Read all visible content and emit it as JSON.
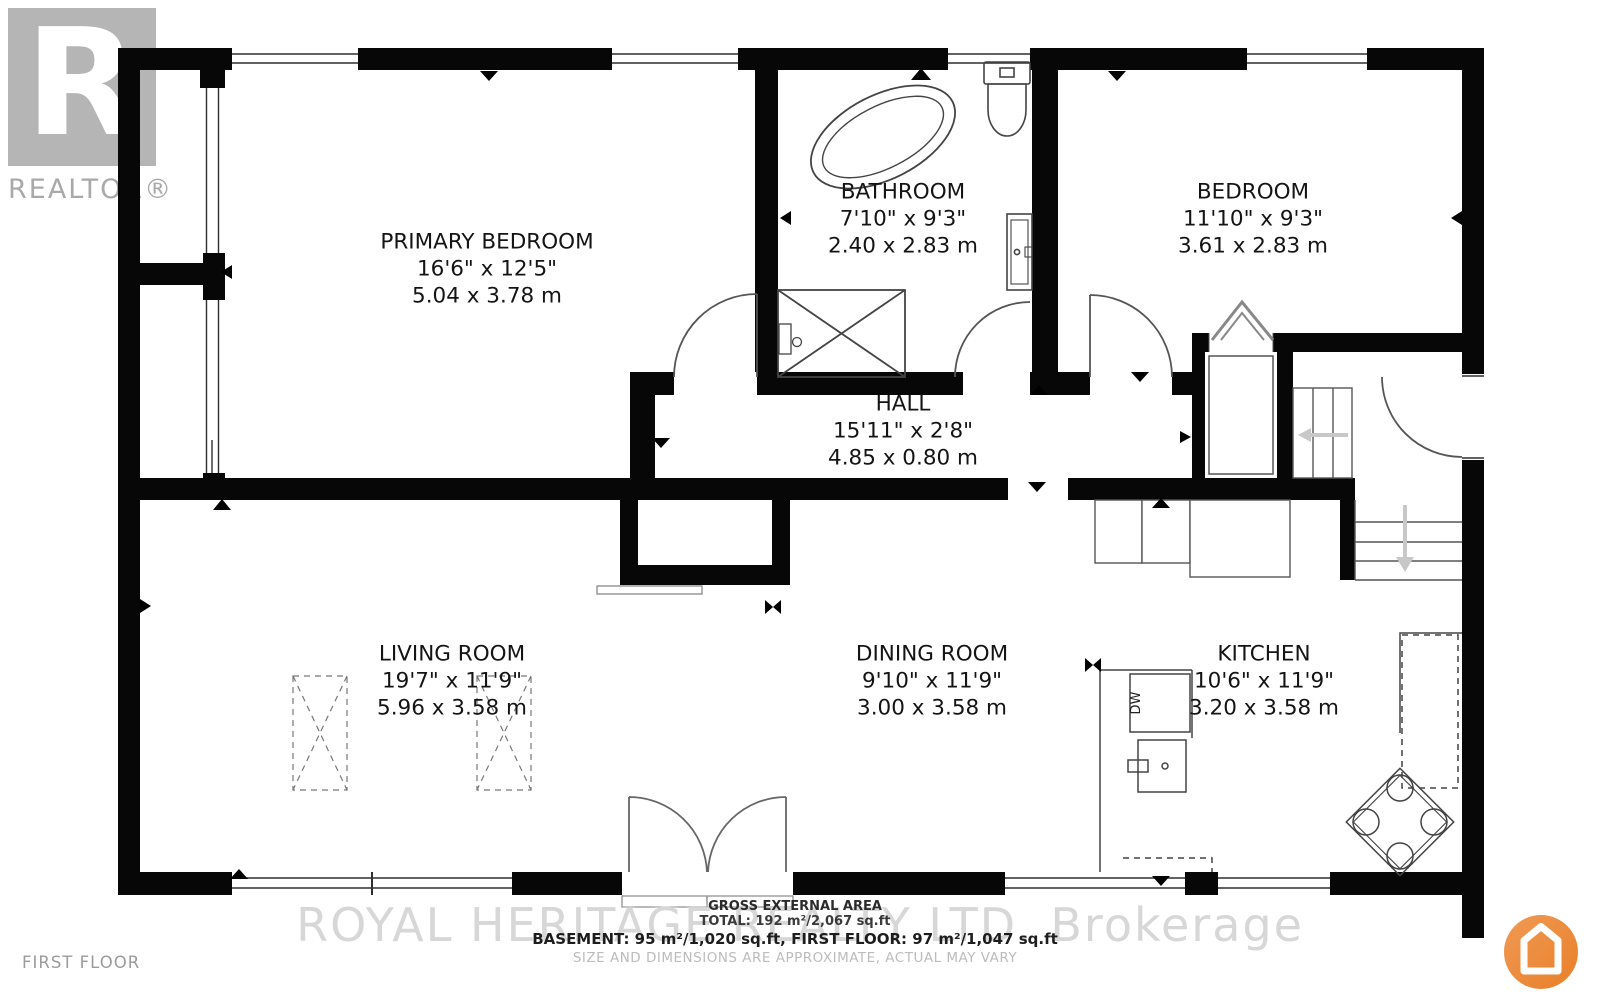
{
  "branding": {
    "realtor_logo_letter": "R",
    "realtor_logo_text": "REALTOR®",
    "floor_label": "FIRST FLOOR",
    "watermark": "ROYAL HERITAGE REALTY LTD.  Brokerage"
  },
  "rooms": [
    {
      "name": "PRIMARY BEDROOM",
      "imperial": "16'6\" x 12'5\"",
      "metric": "5.04 x 3.78 m"
    },
    {
      "name": "BATHROOM",
      "imperial": "7'10\" x 9'3\"",
      "metric": "2.40 x 2.83 m"
    },
    {
      "name": "BEDROOM",
      "imperial": "11'10\" x 9'3\"",
      "metric": "3.61 x 2.83 m"
    },
    {
      "name": "HALL",
      "imperial": "15'11\" x 2'8\"",
      "metric": "4.85 x 0.80 m"
    },
    {
      "name": "LIVING ROOM",
      "imperial": "19'7\" x 11'9\"",
      "metric": "5.96 x 3.58 m"
    },
    {
      "name": "DINING ROOM",
      "imperial": "9'10\" x 11'9\"",
      "metric": "3.00 x 3.58 m"
    },
    {
      "name": "KITCHEN",
      "imperial": "10'6\" x 11'9\"",
      "metric": "3.20 x 3.58 m"
    }
  ],
  "fixtures": {
    "dishwasher_label": "DW"
  },
  "footer": {
    "line1": "GROSS EXTERNAL AREA",
    "line2": "TOTAL: 192 m²/2,067 sq.ft",
    "line3": "BASEMENT: 95 m²/1,020 sq.ft, FIRST FLOOR: 97 m²/1,047 sq.ft",
    "line4": "SIZE AND DIMENSIONS ARE APPROXIMATE, ACTUAL MAY VARY"
  },
  "colors": {
    "wall": "#070707",
    "accent_orange": "#ED8733",
    "watermark_gray": "#d7d7d7"
  }
}
